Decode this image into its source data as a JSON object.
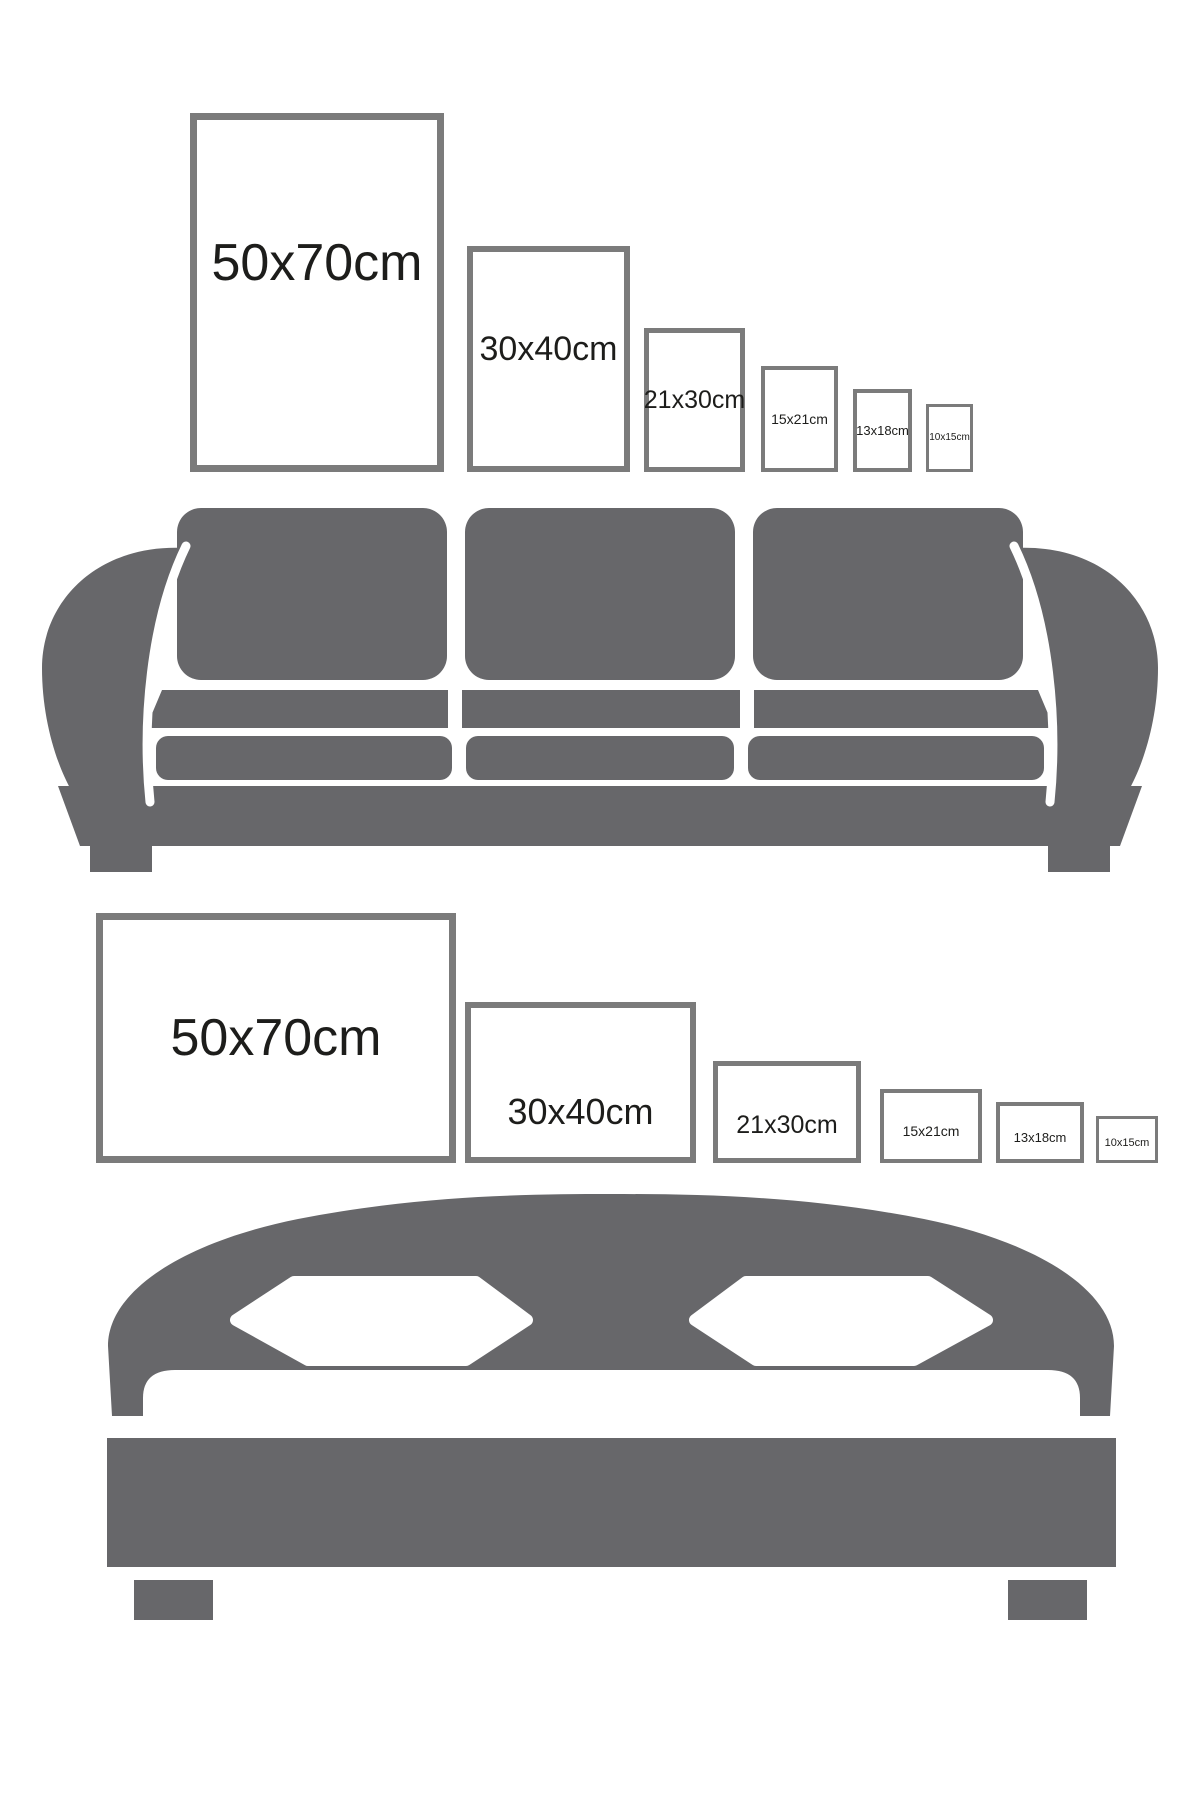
{
  "colors": {
    "furniture_gray": "#67676a",
    "frame_border_gray": "#7b7b7b",
    "label_color": "#1d1d1b",
    "background": "#ffffff"
  },
  "sofa_scene": {
    "furniture": "sofa",
    "orientation": "portrait",
    "frames": [
      {
        "label": "50x70cm"
      },
      {
        "label": "30x40cm"
      },
      {
        "label": "21x30cm"
      },
      {
        "label": "15x21cm"
      },
      {
        "label": "13x18cm"
      },
      {
        "label": "10x15cm"
      }
    ]
  },
  "bed_scene": {
    "furniture": "bed",
    "orientation": "landscape",
    "frames": [
      {
        "label": "50x70cm"
      },
      {
        "label": "30x40cm"
      },
      {
        "label": "21x30cm"
      },
      {
        "label": "15x21cm"
      },
      {
        "label": "13x18cm"
      },
      {
        "label": "10x15cm"
      }
    ]
  }
}
